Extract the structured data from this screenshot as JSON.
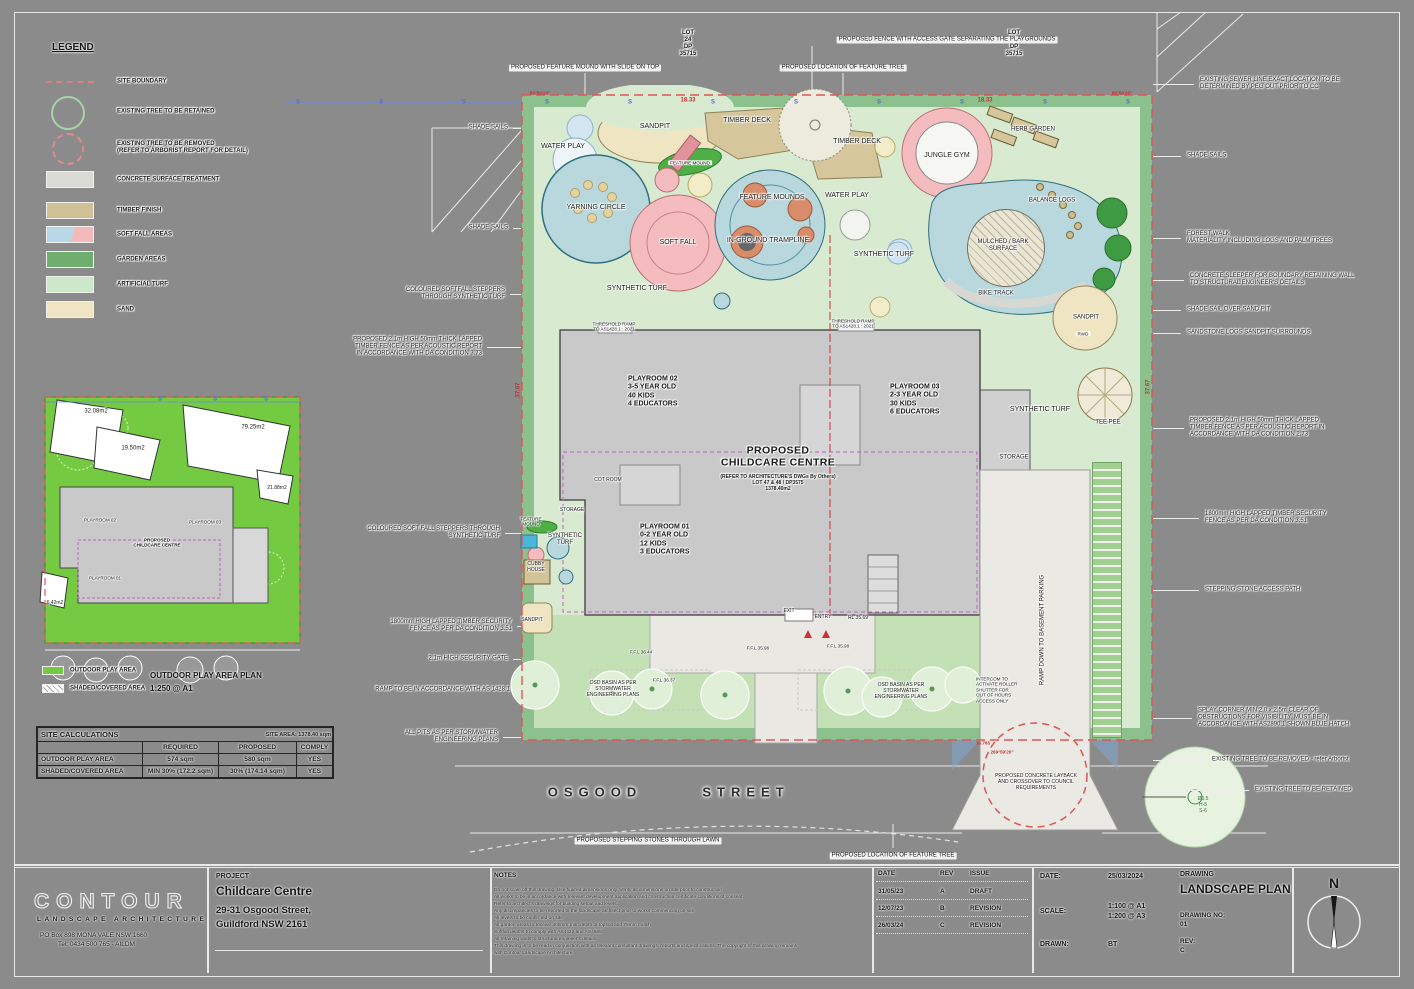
{
  "colors": {
    "sheet": "#8b8b8b",
    "boundary_red": "#e05555",
    "garden": "#8cc08c",
    "turf": "#d8ebd1",
    "lawn": "#c3e1b5",
    "building": "#c9c9c9",
    "sand": "#efe5c3",
    "timber": "#d5c79b",
    "softfall_blue": "#b9d8de",
    "softfall_pink": "#f4bcbf",
    "inset_green": "#74cb41",
    "sewer_blue": "#6a86e8"
  },
  "legend": {
    "title": "LEGEND",
    "items": [
      {
        "kind": "line",
        "y": 82,
        "label": "SITE BOUNDARY"
      },
      {
        "kind": "tree",
        "y": 112,
        "label": "EXISTING TREE TO BE RETAINED"
      },
      {
        "kind": "treerem",
        "y": 148,
        "label": "EXISTING TREE TO BE REMOVED\n(REFER TO ARBORIST REPORT FOR DETAIL)"
      },
      {
        "kind": "fill",
        "color": "#dadad6",
        "y": 180,
        "label": "CONCRETE SURFACE TREATMENT"
      },
      {
        "kind": "fill",
        "color": "#cfc096",
        "y": 211,
        "label": "TIMBER FINISH"
      },
      {
        "kind": "split",
        "color": "#b8d8e8",
        "color2": "#f3babd",
        "y": 235,
        "label": "SOFT FALL AREAS"
      },
      {
        "kind": "fill",
        "color": "#6fae6f",
        "y": 260,
        "label": "GARDEN AREAS"
      },
      {
        "kind": "fill",
        "color": "#cde8c8",
        "y": 285,
        "label": "ARTIFICIAL TURF"
      },
      {
        "kind": "fill",
        "color": "#efe5c3",
        "y": 310,
        "label": "SAND"
      }
    ]
  },
  "plan": {
    "sewer": {
      "symbol": "S",
      "y": 103,
      "xs": [
        298,
        381,
        464,
        547,
        630,
        713,
        796,
        879,
        962,
        1045,
        1128
      ]
    },
    "inset_sewer": {
      "symbol": "S",
      "y": 400,
      "xs": [
        160,
        215,
        266
      ]
    },
    "labels": [
      {
        "t": "WATER PLAY",
        "x": 563,
        "y": 147
      },
      {
        "t": "SANDPIT",
        "x": 655,
        "y": 127
      },
      {
        "t": "TIMBER DECK",
        "x": 747,
        "y": 121
      },
      {
        "t": "TIMBER DECK",
        "x": 857,
        "y": 142
      },
      {
        "t": "FEATURE MOUND",
        "x": 690,
        "y": 163,
        "c": "micro4 chip"
      },
      {
        "t": "JUNGLE GYM",
        "x": 947,
        "y": 156
      },
      {
        "t": "HERB GARDEN",
        "x": 1033,
        "y": 130,
        "c": "tiny"
      },
      {
        "t": "YARNING CIRCLE",
        "x": 596,
        "y": 208
      },
      {
        "t": "FEATURE MOUNDS",
        "x": 772,
        "y": 198
      },
      {
        "t": "WATER PLAY",
        "x": 847,
        "y": 196
      },
      {
        "t": "BALANCE LOGS",
        "x": 1052,
        "y": 201,
        "c": "tiny"
      },
      {
        "t": "SOFT FALL",
        "x": 678,
        "y": 243
      },
      {
        "t": "IN-GROUND TRAMPLINE",
        "x": 768,
        "y": 241
      },
      {
        "t": "MULCHED / BARK\nSURFACE",
        "x": 1003,
        "y": 246,
        "c": "tiny"
      },
      {
        "t": "SYNTHETIC TURF",
        "x": 884,
        "y": 255
      },
      {
        "t": "BIKE TRACK",
        "x": 996,
        "y": 294,
        "c": "tiny"
      },
      {
        "t": "SYNTHETIC TURF",
        "x": 637,
        "y": 289
      },
      {
        "t": "SANDPIT",
        "x": 1086,
        "y": 318,
        "c": "tiny"
      },
      {
        "t": "RWD",
        "x": 1083,
        "y": 334,
        "c": "micro4 chip"
      },
      {
        "t": "SYNTHETIC TURF",
        "x": 1040,
        "y": 410
      },
      {
        "t": "TEE PEE",
        "x": 1108,
        "y": 423,
        "c": "tiny"
      },
      {
        "t": "STORAGE",
        "x": 1014,
        "y": 458,
        "c": "tiny"
      },
      {
        "t": "STORAGE",
        "x": 572,
        "y": 511,
        "c": "micro"
      },
      {
        "t": "COT ROOM",
        "x": 608,
        "y": 481,
        "c": "micro"
      },
      {
        "t": "FEATURE\nMOUND",
        "x": 531,
        "y": 522,
        "c": "micro4"
      },
      {
        "t": "SYNTHETIC\nTURF",
        "x": 565,
        "y": 540,
        "c": "tiny"
      },
      {
        "t": "CUBBY\nHOUSE",
        "x": 536,
        "y": 568,
        "c": "micro"
      },
      {
        "t": "SANDPIT",
        "x": 532,
        "y": 621,
        "c": "micro"
      },
      {
        "t": "PLAYROOM 02\n3-5 YEAR OLD\n40 KIDS\n4 EDUCATORS",
        "x": 628,
        "y": 392,
        "c": "bold",
        "a": "l"
      },
      {
        "t": "PLAYROOM 03\n2-3 YEAR OLD\n30 KIDS\n6 EDUCATORS",
        "x": 890,
        "y": 400,
        "c": "bold",
        "a": "l"
      },
      {
        "t": "PLAYROOM 01\n0-2 YEAR OLD\n12 KIDS\n3 EDUCATORS",
        "x": 640,
        "y": 540,
        "c": "bold",
        "a": "l"
      },
      {
        "t": "PROPOSED\nCHILDCARE CENTRE",
        "x": 778,
        "y": 457,
        "c": "big"
      },
      {
        "t": "(REFER TO ARCHITECTURE'S DWGs By Others)\nLOT 47 & 48 / DP3575\n1378.40m2",
        "x": 778,
        "y": 484,
        "c": "micro bold"
      },
      {
        "t": "ENTRY",
        "x": 823,
        "y": 618,
        "c": "micro"
      },
      {
        "t": "EXIT",
        "x": 789,
        "y": 612,
        "c": "micro"
      },
      {
        "t": "RL 35.69",
        "x": 858,
        "y": 619,
        "c": "micro"
      },
      {
        "t": "F.F.L 36.44",
        "x": 641,
        "y": 652,
        "c": "micro4"
      },
      {
        "t": "F.F.L 36.37",
        "x": 664,
        "y": 680,
        "c": "micro4"
      },
      {
        "t": "F.F.L 35.96",
        "x": 758,
        "y": 648,
        "c": "micro4"
      },
      {
        "t": "F.F.L 35.98",
        "x": 838,
        "y": 646,
        "c": "micro4"
      },
      {
        "t": "OSD BASIN AS PER\nSTORMWATER\nENGINEERING PLANS",
        "x": 613,
        "y": 690,
        "c": "micro"
      },
      {
        "t": "OSD BASIN AS PER\nSTORMWATER\nENGINEERING PLANS",
        "x": 901,
        "y": 692,
        "c": "micro"
      },
      {
        "t": "THRESHOLD RAMP\nTO AS1428.1 : 2021",
        "x": 614,
        "y": 327,
        "c": "micro4"
      },
      {
        "t": "THRESHOLD RAMP\nTO AS1428.1 : 2021",
        "x": 853,
        "y": 324,
        "c": "micro4"
      },
      {
        "t": "INTERCOM TO\nACTIVATE ROLLER\nSHUTTER FOR\nOUT OF HOURS\nACCESS ONLY",
        "x": 976,
        "y": 690,
        "c": "micro4",
        "a": "l"
      },
      {
        "t": "RAMP DOWN TO BASEMENT PARKING",
        "x": 1043,
        "y": 630,
        "c": "tiny vert"
      },
      {
        "t": "PROPOSED CONCRETE LAYBACK\nAND CROSSOVER TO COUNCIL\nREQUIREMENTS",
        "x": 1036,
        "y": 783,
        "c": "micro"
      },
      {
        "t": "OSGOOD",
        "x": 595,
        "y": 792,
        "c": "street"
      },
      {
        "t": "STREET",
        "x": 746,
        "y": 792,
        "c": "street"
      },
      {
        "t": "Ø0.5\nH-5\nS-6",
        "x": 1203,
        "y": 806,
        "c": "micro green"
      },
      {
        "t": "18.33",
        "x": 688,
        "y": 101,
        "c": "tiny red"
      },
      {
        "t": "18.33",
        "x": 985,
        "y": 101,
        "c": "tiny red"
      },
      {
        "t": "89°59'20\"",
        "x": 540,
        "y": 93,
        "c": "micro4 red"
      },
      {
        "t": "89°59'20\"",
        "x": 1122,
        "y": 93,
        "c": "micro4 red"
      },
      {
        "t": "37.67",
        "x": 519,
        "y": 390,
        "c": "tiny red vert"
      },
      {
        "t": "37.67",
        "x": 1149,
        "y": 387,
        "c": "tiny red vert"
      },
      {
        "t": "269°59'20\"",
        "x": 1002,
        "y": 752,
        "c": "micro4 red"
      },
      {
        "t": "16.765",
        "x": 983,
        "y": 743,
        "c": "micro4 red"
      },
      {
        "t": "LOT\n24\nDP\n35715",
        "x": 688,
        "y": 44,
        "c": "tiny bold"
      },
      {
        "t": "LOT\n24\nDP\n35715",
        "x": 1014,
        "y": 44,
        "c": "tiny bold"
      },
      {
        "t": "PROPOSED FEATURE MOUND WITH SLIDE ON TOP",
        "x": 585,
        "y": 68,
        "c": "tiny chip"
      },
      {
        "t": "PROPOSED FENCE WITH ACCESS GATE SEPARATING THE PLAYGROUNDS",
        "x": 947,
        "y": 40,
        "c": "tiny chip"
      },
      {
        "t": "PROPOSED LOCATION OF FEATURE TREE",
        "x": 843,
        "y": 68,
        "c": "tiny chip"
      },
      {
        "t": "PROPOSED STEPPING STONES THROUGH LAWN",
        "x": 648,
        "y": 841,
        "c": "tiny chip"
      },
      {
        "t": "PROPOSED LOCATION OF FEATURE TREE",
        "x": 893,
        "y": 856,
        "c": "tiny chip"
      },
      {
        "t": "32.08m2",
        "x": 96,
        "y": 412,
        "c": "tiny"
      },
      {
        "t": "19.50m2",
        "x": 133,
        "y": 449,
        "c": "tiny"
      },
      {
        "t": "79.25m2",
        "x": 253,
        "y": 428,
        "c": "tiny"
      },
      {
        "t": "21.88m2",
        "x": 277,
        "y": 489,
        "c": "micro"
      },
      {
        "t": "6.42m2",
        "x": 55,
        "y": 604,
        "c": "micro"
      },
      {
        "t": "PLAYROOM 02",
        "x": 100,
        "y": 520,
        "c": "micro4"
      },
      {
        "t": "PLAYROOM 03",
        "x": 205,
        "y": 522,
        "c": "micro4"
      },
      {
        "t": "PLAYROOM 01",
        "x": 105,
        "y": 578,
        "c": "micro4"
      },
      {
        "t": "PROPOSED\nCHILDCARE CENTRE",
        "x": 157,
        "y": 543,
        "c": "micro4 bold"
      }
    ],
    "annotations_left": [
      {
        "t": "SHADE SAILS",
        "x": 508,
        "y": 128
      },
      {
        "t": "SHADE SAILS",
        "x": 508,
        "y": 228
      },
      {
        "t": "COLOURED SOFTFALL STEPPERS\nTHROUGH SYNTHETIC TURF",
        "x": 505,
        "y": 294
      },
      {
        "t": "PROPOSED 2.1m HIGH 50mm THICK LAPPED\nTIMBER FENCE AS PER ACOUSTIC REPORT\nIN ACCORDANCE WITH DA CONDITION 3.73",
        "x": 482,
        "y": 347
      },
      {
        "t": "COLOURED SOFT FALL STEPPERS THROUGH\nSYNTHETIC TURF",
        "x": 500,
        "y": 533
      },
      {
        "t": "1800mm HIGH LAPPED TIMBER SECURITY\nFENCE AS PER DA CONDITION 3.51",
        "x": 512,
        "y": 626
      },
      {
        "t": "2.1m HIGH SECURITY GATE",
        "x": 508,
        "y": 659
      },
      {
        "t": "RAMP TO BE IN ACCORDANCE WITH AS 1428.1",
        "x": 510,
        "y": 690
      },
      {
        "t": "ALL PITS AS PER STORMWATER\nENGINEERING PLANS",
        "x": 498,
        "y": 737
      }
    ],
    "annotations_right": [
      {
        "t": "EXISTING SEWER LINE EXACT LOCATION TO BE\nDETERMINED BY PEG OUT PRIOR TO CC",
        "x": 1200,
        "y": 84
      },
      {
        "t": "SHADE SAILS",
        "x": 1187,
        "y": 156
      },
      {
        "t": "FOREST WALK\nMATERIALITY INCLUDING LOGS AND PALM TREES",
        "x": 1187,
        "y": 238
      },
      {
        "t": "CONCRETE SLEEPER FOR BOUNDARY RETAINING WALL\nTO STRUCTURAL ENGINEER'S DETAILS",
        "x": 1190,
        "y": 280
      },
      {
        "t": "SHADE SAIL OVER SAND PIT",
        "x": 1187,
        "y": 310
      },
      {
        "t": "SANDSTONE LOGS SANDPIT SURROUNDS",
        "x": 1187,
        "y": 333
      },
      {
        "t": "PROPOSED 2.1m HIGH 50mm THICK LAPPED\nTIMBER FENCE AS PER ACOUSTIC REPORT IN\nACCORDANCE WITH DA CONDITION 2.73",
        "x": 1190,
        "y": 428
      },
      {
        "t": "1800mm HIGH LAPPED TIMBER SECURITY\nFENCE AS PER DA CONDITION 3.51",
        "x": 1205,
        "y": 518
      },
      {
        "t": "STEPPING STONE ACCESS PATH",
        "x": 1205,
        "y": 590
      },
      {
        "t": "SPLAY CORNER MIN 2.0 x 2.5m CLEAR OF\nOBSTRUCTIONS FOR VISIBILITY. MUST BE IN\nACCORDANCE WITH AS2890.1 SHOWN BLUE HATCH",
        "x": 1198,
        "y": 718
      },
      {
        "t": "EXISTING TREE TO BE REMOVED - refer Arborist",
        "x": 1212,
        "y": 760
      },
      {
        "t": "EXISTING TREE TO BE RETAINED",
        "x": 1255,
        "y": 790
      }
    ]
  },
  "inset": {
    "title": "OUTDOOR PLAY AREA PLAN",
    "scale": "1:250 @ A1",
    "legend": [
      {
        "color": "#74cb41",
        "label": "OUTDOOR PLAY AREA"
      },
      {
        "color": "hatch",
        "label": "SHADED/COVERED AREA"
      }
    ]
  },
  "site_calculations": {
    "title": "SITE CALCULATIONS",
    "site_area": "SITE AREA: 1378.40 sqm",
    "col_headers": [
      "",
      "REQUIRED",
      "PROPOSED",
      "COMPLY"
    ],
    "rows": [
      [
        "OUTDOOR PLAY AREA",
        "574 sqm",
        "580 sqm",
        "YES"
      ],
      [
        "SHADED/COVERED AREA",
        "MIN 30%  (172.2 sqm)",
        "30% (174.14 sqm)",
        "YES"
      ]
    ]
  },
  "title_block": {
    "logo": {
      "name": "CONTOUR",
      "sub": "LANDSCAPE ARCHITECTURE",
      "addr1": "PO Box 898 MONA VALE NSW 1660",
      "addr2": "Tel: 0434 500 765 - AILDM"
    },
    "project": {
      "label": "PROJECT",
      "name": "Childcare Centre",
      "addr1": "29-31 Osgood Street,",
      "addr2": "Guildford NSW 2161"
    },
    "notes": {
      "label": "NOTES",
      "lines": [
        "Do not scale off this drawing. Use figured dimensions only. Verify all dimensions on site prior to construction.",
        "All works to be in accordance with relevant development application and construction certificate conditions of consent.",
        "Refer to architect's drawings for building setout and levels.",
        "Any discrepancies to be reported to the landscape architect prior to works commencing on site.",
        "All levels to be confirmed on site.",
        "All garden areas to receive 300mm min. depth of topsoil and 75mm mulch.",
        "Softfall depths to comply with AS4422 and AS4685.",
        "All retaining walls to structural engineer's details.",
        "This drawing is to be read in conjunction with all relevant consultant drawings, reports and specifications. The copyright of this drawing remains",
        "with Contour Landscape Architecture."
      ]
    },
    "revisions": {
      "headers": [
        "DATE",
        "REV",
        "ISSUE"
      ],
      "rows": [
        [
          "31/05/23",
          "A",
          "DRAFT"
        ],
        [
          "12/07/23",
          "B",
          "REVISION"
        ],
        [
          "26/03/24",
          "C",
          "REVISION"
        ]
      ]
    },
    "info": {
      "date_label": "DATE:",
      "date": "25/03/2024",
      "scale_label": "SCALE:",
      "scale1": "1:100 @ A1",
      "scale2": "1:200 @ A3",
      "drawn_label": "DRAWN:",
      "drawn": "BT",
      "drawing_label": "DRAWING",
      "drawing": "LANDSCAPE PLAN",
      "no_label": "DRAWING NO:",
      "no": "01",
      "rev_label": "REV:",
      "rev": "C",
      "north": "N"
    }
  }
}
